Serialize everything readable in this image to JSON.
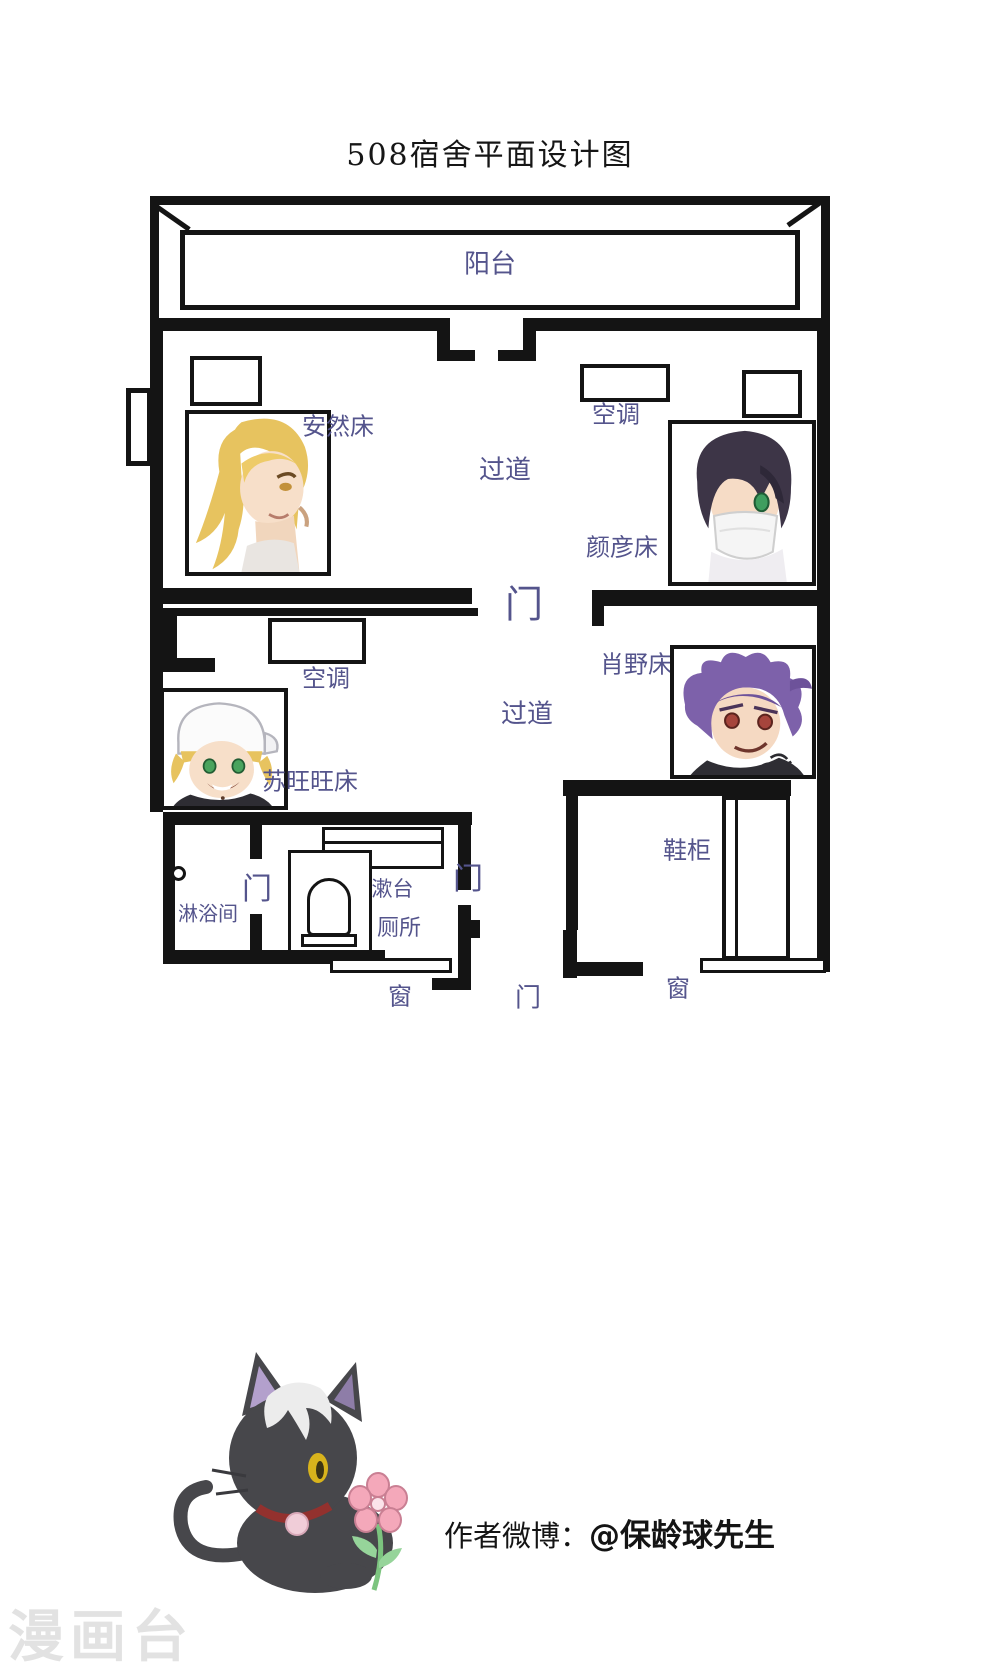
{
  "page": {
    "title": "508宿舍平面设计图"
  },
  "plan": {
    "balcony": "阳台",
    "corridor_upper": "过道",
    "corridor_lower": "过道",
    "door_main": "门",
    "door_bathroom": "门",
    "door_middle": "门",
    "door_bottom": "门",
    "ac_upper_right": "空调",
    "ac_lower_left": "空调",
    "bed_anran": "安然床",
    "bed_yanyan": "颜彦床",
    "bed_suwangwang": "苏旺旺床",
    "bed_xiaoye": "肖野床",
    "washstand": "洗漱台",
    "shower_room": "淋浴间",
    "toilet": "厕所",
    "shoe_cabinet": "鞋柜",
    "window_bottom_left": "窗",
    "window_bottom_right": "窗"
  },
  "footer": {
    "credit_prefix": "作者微博：",
    "credit_handle": "@保龄球先生",
    "watermark": "漫画台"
  },
  "colors": {
    "label": "#54548c",
    "wall": "#141414",
    "hair_blonde": "#e7c35f",
    "hair_dark": "#3d3547",
    "hair_purple": "#7d61aa",
    "watermark": "#e2e2e2"
  }
}
